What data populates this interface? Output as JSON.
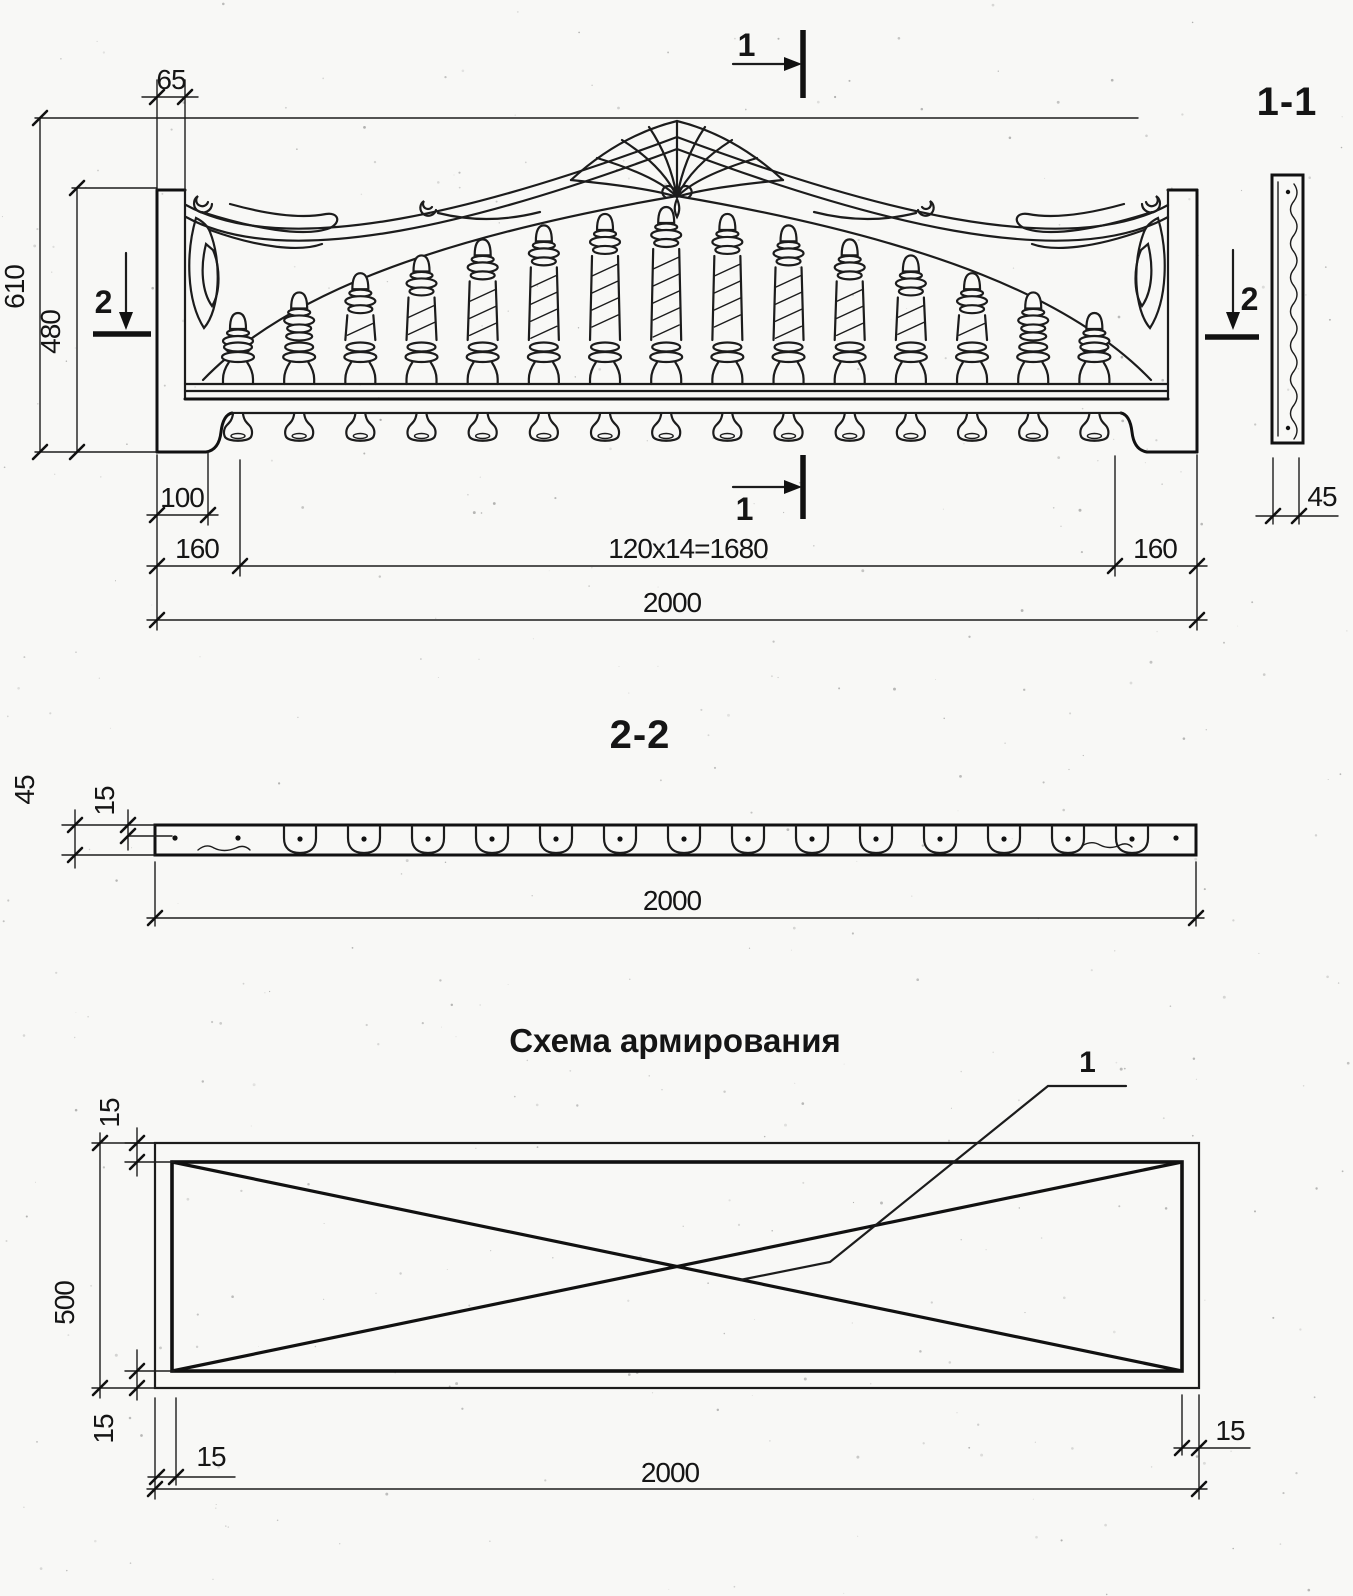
{
  "elevation": {
    "marker1": "1",
    "marker2": "2",
    "dims": {
      "post_width": "65",
      "height_total": "610",
      "height_inner": "480",
      "foot_width": "100",
      "margin_left": "160",
      "baluster_spacing": "120x14=1680",
      "margin_right": "160",
      "width_total": "2000"
    }
  },
  "section_1_1": {
    "title": "1-1",
    "dims": {
      "thickness": "45"
    }
  },
  "section_2_2": {
    "title": "2-2",
    "dims": {
      "thickness": "45",
      "bar_depth": "15",
      "length": "2000"
    }
  },
  "reinforcement": {
    "title": "Схема армирования",
    "callout": "1",
    "dims": {
      "cover_top": "15",
      "height": "500",
      "cover_bottom": "15",
      "cover_left": "15",
      "cover_right": "15",
      "length": "2000"
    }
  }
}
